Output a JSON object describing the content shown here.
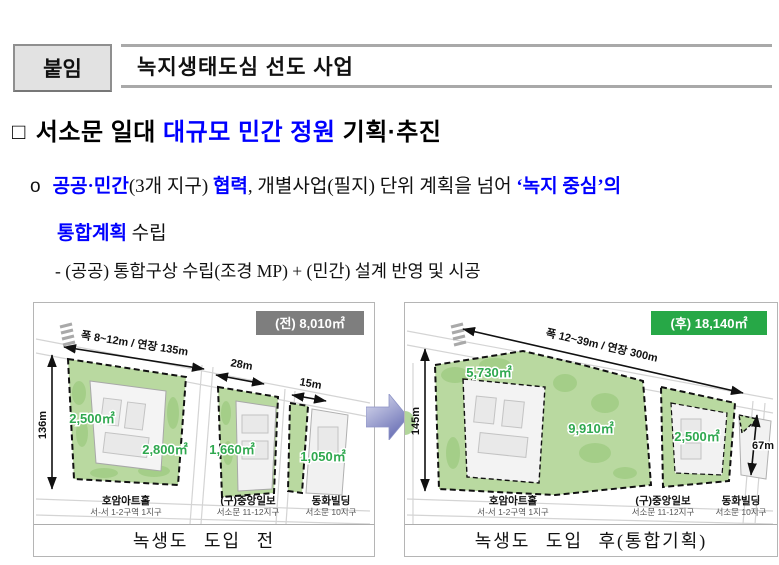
{
  "header": {
    "badge": "붙임",
    "title": "녹지생태도심 선도 사업"
  },
  "heading": {
    "bullet": "□",
    "pre": "서소문 일대 ",
    "highlight": "대규모 민간 정원",
    "post": " 기획·추진"
  },
  "para1": {
    "bullet": "o",
    "seg_blue1": "공공·민간",
    "seg2": "(3개 지구) ",
    "seg_blue2": "협력",
    "seg3": ", 개별사업(필지) 단위 계획을 넘어 ",
    "seg_blue3": "‘녹지 중심’의",
    "line2_blue": "통합계획",
    "line2_rest": " 수립"
  },
  "para2": "- (공공) 통합구상 수립(조경 MP) + (민간) 설계 반영 및 시공",
  "maps": {
    "before": {
      "badge": "(전) 8,010㎡",
      "badge_color": "#7e7e7e",
      "dim_top": "폭 8~12m / 연장 135m",
      "dim_left": "136m",
      "dim_mid": "28m",
      "dim_right": "15m",
      "areas": [
        "2,500㎡",
        "2,800㎡",
        "1,660㎡",
        "1,050㎡"
      ],
      "buildings": [
        {
          "name": "호암아트홀",
          "sub": "서-서 1-2구역 1지구"
        },
        {
          "name": "(구)중앙일보",
          "sub": "서소문 11-12지구"
        },
        {
          "name": "동화빌딩",
          "sub": "서소문 10지구"
        }
      ],
      "caption": "녹생도 도입 전"
    },
    "after": {
      "badge": "(후) 18,140㎡",
      "badge_color": "#27a847",
      "dim_top": "폭 12~39m / 연장 300m",
      "dim_left": "145m",
      "dim_right": "67m",
      "areas": [
        "5,730㎡",
        "9,910㎡",
        "2,500㎡"
      ],
      "buildings": [
        {
          "name": "호암아트홀",
          "sub": "서-서 1-2구역 1지구"
        },
        {
          "name": "(구)중앙일보",
          "sub": "서소문 11-12지구"
        },
        {
          "name": "동화빌딩",
          "sub": "서소문 10지구"
        }
      ],
      "caption": "녹생도 도입 후(통합기획)"
    }
  },
  "colors": {
    "accent_blue": "#0000ff",
    "park_green": "#b9d9a0",
    "label_green": "#2fa84f"
  }
}
